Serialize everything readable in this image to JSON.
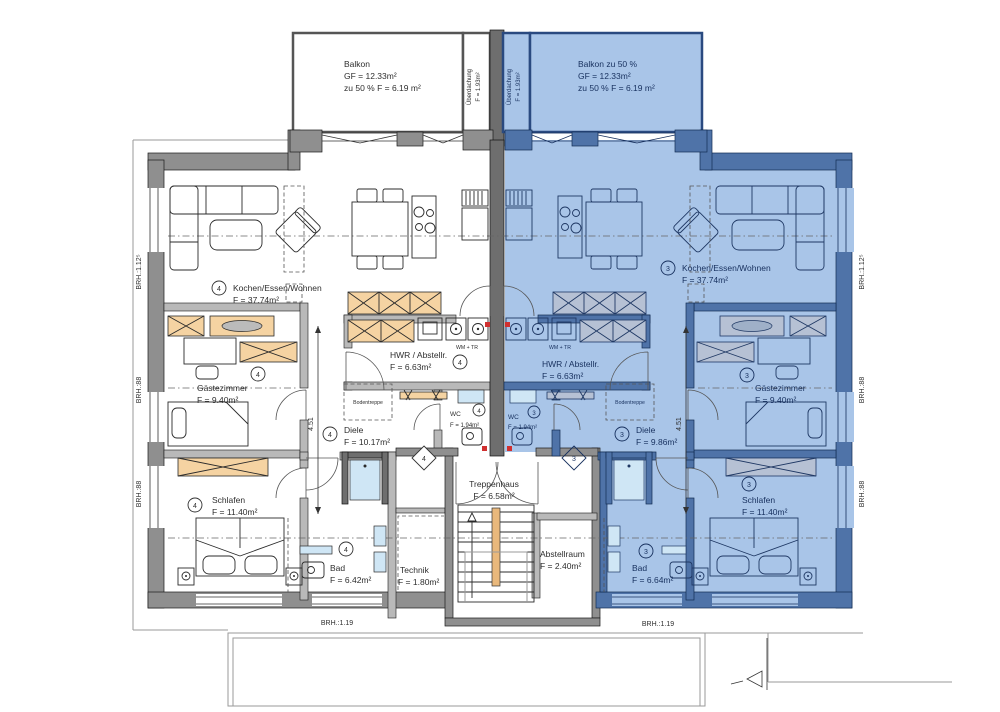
{
  "plan": {
    "balcony_left": {
      "l1": "Balkon",
      "l2": "GF = 12.33m²",
      "l3": "zu 50 % F = 6.19 m²"
    },
    "balcony_right": {
      "l1": "Balkon zu 50 %",
      "l2": "GF = 12.33m²",
      "l3": "zu 50 % F = 6.19 m²"
    },
    "canopy": {
      "l1": "Überdachung",
      "l2": "F = 1.93m²"
    },
    "unit_left": {
      "no": "4",
      "wohnen": {
        "name": "Kochen/Essen/Wohnen",
        "area": "F = 37.74m²"
      },
      "gaeste": {
        "name": "Gästezimmer",
        "area": "F = 9.40m²"
      },
      "schlafen": {
        "name": "Schlafen",
        "area": "F = 11.40m²"
      },
      "bad": {
        "name": "Bad",
        "area": "F = 6.42m²"
      },
      "hwr": {
        "name": "HWR / Abstellr.",
        "area": "F = 6.63m²"
      },
      "wc": {
        "name": "WC",
        "area": "F = 1.94m²"
      },
      "diele": {
        "name": "Diele",
        "area": "F = 10.17m²"
      },
      "wm": "WM + TR",
      "bodentreppe": "Bodentreppe"
    },
    "unit_right": {
      "no": "3",
      "wohnen": {
        "name": "Kochen/Essen/Wohnen",
        "area": "F = 37.74m²"
      },
      "gaeste": {
        "name": "Gästezimmer",
        "area": "F = 9.40m²"
      },
      "schlafen": {
        "name": "Schlafen",
        "area": "F = 11.40m²"
      },
      "bad": {
        "name": "Bad",
        "area": "F = 6.64m²"
      },
      "hwr": {
        "name": "HWR / Abstellr.",
        "area": "F = 6.63m²"
      },
      "wc": {
        "name": "WC",
        "area": "F = 1.94m²"
      },
      "diele": {
        "name": "Diele",
        "area": "F = 9.86m²"
      },
      "wm": "WM + TR",
      "bodentreppe": "Bodentreppe"
    },
    "core": {
      "treppenhaus": {
        "name": "Treppenhaus",
        "area": "F = 6.58m²"
      },
      "abstellraum": {
        "name": "Abstellraum",
        "area": "F = 2.40m²"
      },
      "technik": {
        "name": "Technik",
        "area": "F = 1.80m²"
      }
    },
    "dims": {
      "v": "4.51"
    },
    "brh": {
      "h112": "BRH.:1.12⁵",
      "h88": "BRH.:88",
      "h119": "BRH.:1.19"
    },
    "colors": {
      "highlight": "#a9c5e8",
      "wall_gray": "#8f8f8f",
      "wall_blue": "#4f73a8",
      "wall_dark": "#6e6e6e",
      "cabinet_orange": "#f5d3a2",
      "cabinet_blue": "#b6c1d4",
      "rail_orange": "#e9b87c",
      "marker_red": "#d03030",
      "fixture_blue": "#cfe6f5"
    }
  }
}
